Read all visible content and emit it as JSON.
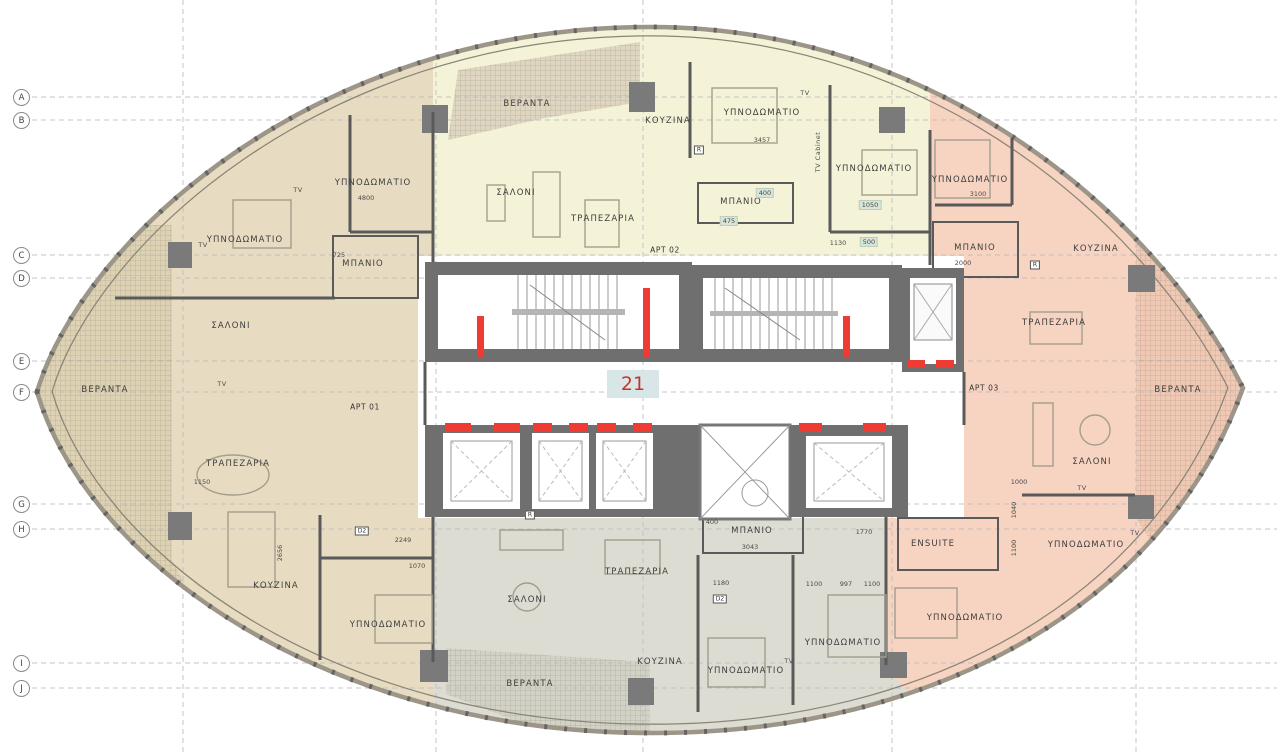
{
  "drawing": {
    "type": "apartment-floor-plan",
    "unit_number": "21",
    "apartment_tags": [
      {
        "label": "APT 01",
        "x": 365,
        "y": 407
      },
      {
        "label": "APT 02",
        "x": 665,
        "y": 250
      },
      {
        "label": "APT 03",
        "x": 984,
        "y": 388
      }
    ],
    "grid": {
      "rows": [
        {
          "label": "A",
          "y": 97
        },
        {
          "label": "B",
          "y": 120
        },
        {
          "label": "C",
          "y": 255
        },
        {
          "label": "D",
          "y": 278
        },
        {
          "label": "E",
          "y": 361
        },
        {
          "label": "F",
          "y": 392
        },
        {
          "label": "G",
          "y": 504
        },
        {
          "label": "H",
          "y": 529
        },
        {
          "label": "I",
          "y": 663
        },
        {
          "label": "J",
          "y": 688
        }
      ],
      "cols": [
        {
          "x": 183
        },
        {
          "x": 436
        },
        {
          "x": 643
        },
        {
          "x": 892
        },
        {
          "x": 1136
        }
      ]
    },
    "rooms": [
      {
        "label": "ΥΠΝΟΔΩΜΑΤΙΟ",
        "x": 373,
        "y": 183
      },
      {
        "label": "ΥΠΝΟΔΩΜΑΤΙΟ",
        "x": 245,
        "y": 240
      },
      {
        "label": "ΜΠΑΝΙΟ",
        "x": 363,
        "y": 264
      },
      {
        "label": "ΣΑΛΟΝΙ",
        "x": 231,
        "y": 326
      },
      {
        "label": "ΒΕΡΑΝΤΑ",
        "x": 105,
        "y": 390
      },
      {
        "label": "ΤΡΑΠΕΖΑΡΙΑ",
        "x": 238,
        "y": 464
      },
      {
        "label": "ΚΟΥΖΙΝΑ",
        "x": 276,
        "y": 586
      },
      {
        "label": "ΥΠΝΟΔΩΜΑΤΙΟ",
        "x": 388,
        "y": 625
      },
      {
        "label": "ΒΕΡΑΝΤΑ",
        "x": 527,
        "y": 104
      },
      {
        "label": "ΚΟΥΖΙΝΑ",
        "x": 668,
        "y": 121
      },
      {
        "label": "ΥΠΝΟΔΩΜΑΤΙΟ",
        "x": 762,
        "y": 113
      },
      {
        "label": "ΣΑΛΟΝΙ",
        "x": 516,
        "y": 193
      },
      {
        "label": "ΤΡΑΠΕΖΑΡΙΑ",
        "x": 603,
        "y": 219
      },
      {
        "label": "ΜΠΑΝΙΟ",
        "x": 741,
        "y": 202
      },
      {
        "label": "ΥΠΝΟΔΩΜΑΤΙΟ",
        "x": 874,
        "y": 169
      },
      {
        "label": "ΥΠΝΟΔΩΜΑΤΙΟ",
        "x": 970,
        "y": 180
      },
      {
        "label": "ΜΠΑΝΙΟ",
        "x": 975,
        "y": 248
      },
      {
        "label": "ΚΟΥΖΙΝΑ",
        "x": 1096,
        "y": 249
      },
      {
        "label": "ΤΡΑΠΕΖΑΡΙΑ",
        "x": 1054,
        "y": 323
      },
      {
        "label": "ΒΕΡΑΝΤΑ",
        "x": 1178,
        "y": 390
      },
      {
        "label": "ΣΑΛΟΝΙ",
        "x": 1092,
        "y": 462
      },
      {
        "label": "ΥΠΝΟΔΩΜΑΤΙΟ",
        "x": 1086,
        "y": 545
      },
      {
        "label": "ENSUITE",
        "x": 933,
        "y": 544
      },
      {
        "label": "ΥΠΝΟΔΩΜΑΤΙΟ",
        "x": 965,
        "y": 618
      },
      {
        "label": "ΜΠΑΝΙΟ",
        "x": 752,
        "y": 531
      },
      {
        "label": "ΤΡΑΠΕΖΑΡΙΑ",
        "x": 637,
        "y": 572
      },
      {
        "label": "ΣΑΛΟΝΙ",
        "x": 527,
        "y": 600
      },
      {
        "label": "ΚΟΥΖΙΝΑ",
        "x": 660,
        "y": 662
      },
      {
        "label": "ΥΠΝΟΔΩΜΑΤΙΟ",
        "x": 746,
        "y": 671
      },
      {
        "label": "ΥΠΝΟΔΩΜΑΤΙΟ",
        "x": 843,
        "y": 643
      },
      {
        "label": "ΒΕΡΑΝΤΑ",
        "x": 530,
        "y": 684
      }
    ],
    "tv_labels": [
      {
        "label": "TV",
        "x": 203,
        "y": 245
      },
      {
        "label": "TV",
        "x": 298,
        "y": 190
      },
      {
        "label": "TV",
        "x": 222,
        "y": 384
      },
      {
        "label": "TV",
        "x": 805,
        "y": 93
      },
      {
        "label": "TV Cabinet",
        "x": 818,
        "y": 152,
        "rot": true
      },
      {
        "label": "TV",
        "x": 789,
        "y": 661
      },
      {
        "label": "TV",
        "x": 1082,
        "y": 488
      },
      {
        "label": "TV",
        "x": 1135,
        "y": 533
      }
    ],
    "dimensions": [
      {
        "text": "4800",
        "x": 366,
        "y": 198
      },
      {
        "text": "3457",
        "x": 762,
        "y": 140
      },
      {
        "text": "3100",
        "x": 978,
        "y": 194
      },
      {
        "text": "2000",
        "x": 963,
        "y": 263
      },
      {
        "text": "725",
        "x": 339,
        "y": 255
      },
      {
        "text": "1130",
        "x": 838,
        "y": 243
      },
      {
        "text": "1050",
        "x": 870,
        "y": 205,
        "tag": true
      },
      {
        "text": "500",
        "x": 869,
        "y": 242,
        "tag": true
      },
      {
        "text": "475",
        "x": 729,
        "y": 221,
        "tag": true
      },
      {
        "text": "400",
        "x": 765,
        "y": 193,
        "tag": true
      },
      {
        "text": "2656",
        "x": 280,
        "y": 553,
        "rot": true
      },
      {
        "text": "2249",
        "x": 403,
        "y": 540
      },
      {
        "text": "1070",
        "x": 417,
        "y": 566
      },
      {
        "text": "1150",
        "x": 202,
        "y": 482
      },
      {
        "text": "3043",
        "x": 750,
        "y": 547
      },
      {
        "text": "1180",
        "x": 721,
        "y": 583
      },
      {
        "text": "1100",
        "x": 814,
        "y": 584
      },
      {
        "text": "997",
        "x": 846,
        "y": 584
      },
      {
        "text": "1100",
        "x": 872,
        "y": 584
      },
      {
        "text": "1770",
        "x": 864,
        "y": 532
      },
      {
        "text": "400",
        "x": 712,
        "y": 522
      },
      {
        "text": "1000",
        "x": 1019,
        "y": 482
      },
      {
        "text": "1040",
        "x": 1014,
        "y": 510,
        "rot": true
      },
      {
        "text": "1100",
        "x": 1014,
        "y": 548,
        "rot": true
      }
    ],
    "appliance_tags": [
      {
        "label": "R",
        "x": 699,
        "y": 150
      },
      {
        "label": "R",
        "x": 1035,
        "y": 265
      },
      {
        "label": "R",
        "x": 530,
        "y": 515
      },
      {
        "label": "D2",
        "x": 362,
        "y": 531
      },
      {
        "label": "D2",
        "x": 720,
        "y": 599
      }
    ],
    "colors": {
      "apt_01_beige": "#e7dcc2",
      "apt_02_yellow": "#f4f3d7",
      "apt_03_pink": "#f7d3c1",
      "apt_04_gray": "#dcdcd3",
      "core_wall": "#6f6f6f",
      "fire_red": "#ee3b33",
      "unit_badge_bg": "#d9e6e8",
      "unit_badge_text": "#c23630"
    }
  }
}
